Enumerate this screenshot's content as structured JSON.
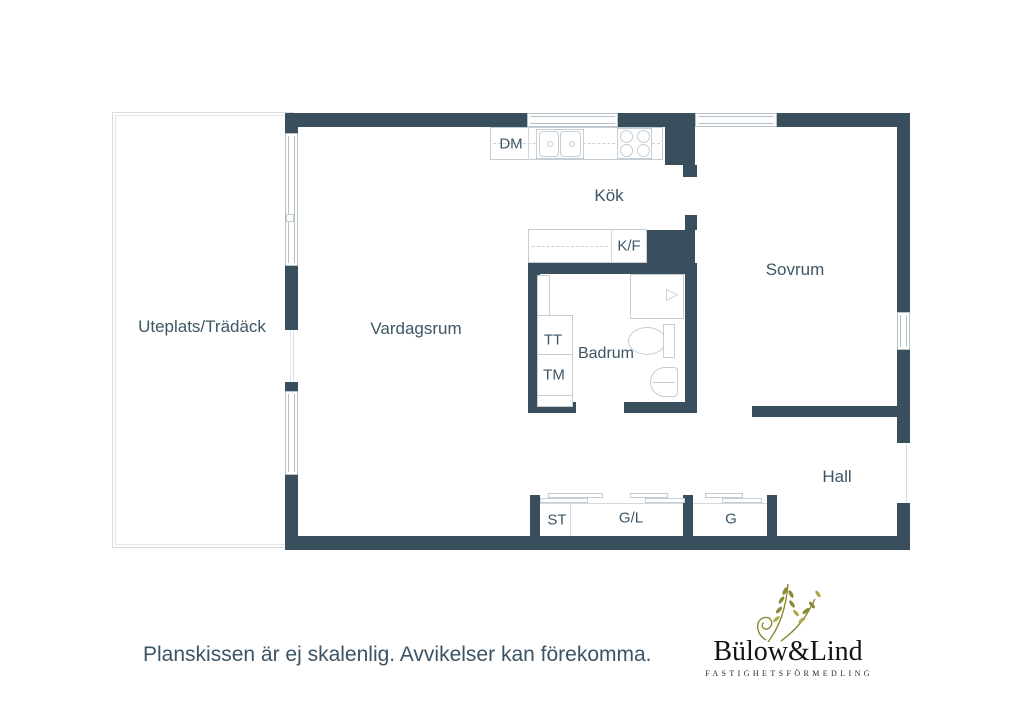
{
  "floorplan": {
    "rooms": {
      "uteplats": "Uteplats/Trädäck",
      "vardagsrum": "Vardagsrum",
      "kok": "Kök",
      "sovrum": "Sovrum",
      "badrum": "Badrum",
      "hall": "Hall"
    },
    "appliances": {
      "dm": "DM",
      "kf": "K/F",
      "tt": "TT",
      "tm": "TM"
    },
    "closets": {
      "st": "ST",
      "gl": "G/L",
      "g": "G"
    }
  },
  "footer": {
    "disclaimer": "Planskissen är ej skalenlig. Avvikelser kan förekomma."
  },
  "logo": {
    "name": "Bülow&Lind",
    "tagline": "FASTIGHETSFÖRMEDLING"
  },
  "colors": {
    "wall": "#3a4f5e",
    "label": "#3e5565",
    "fixture_outline": "#c4cdd3",
    "logo_accent": "#8a8a32"
  }
}
